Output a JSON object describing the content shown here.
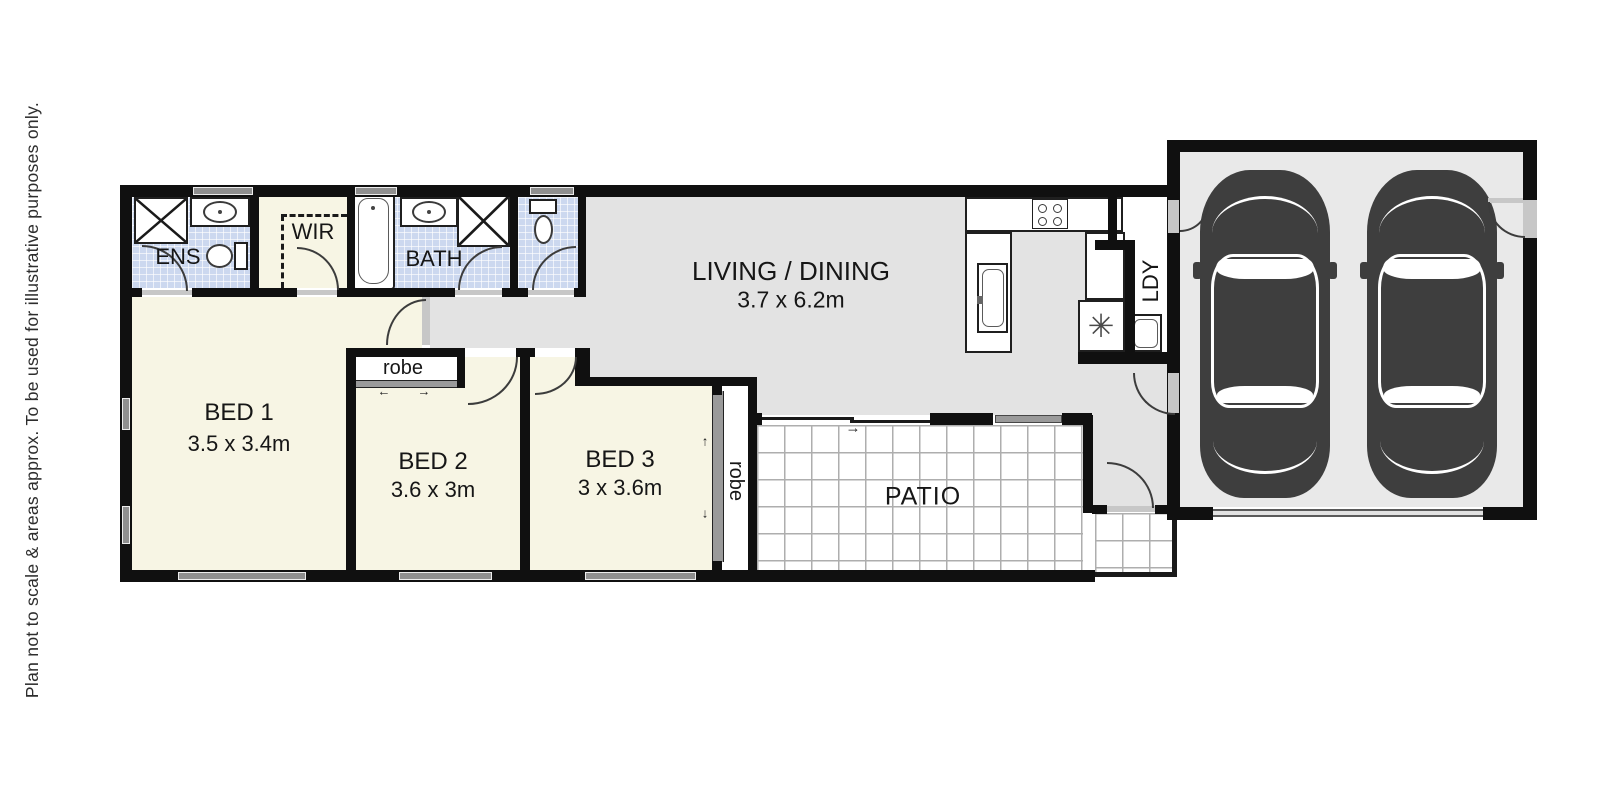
{
  "disclaimer": "Plan not to scale & areas approx. To be used for illustrative purposes only.",
  "rooms": {
    "ens": {
      "label": "ENS"
    },
    "wir": {
      "label": "WIR"
    },
    "bath": {
      "label": "BATH"
    },
    "bed1": {
      "label": "BED 1",
      "dims": "3.5 x 3.4m"
    },
    "bed2": {
      "label": "BED 2",
      "dims": "3.6 x 3m"
    },
    "bed3": {
      "label": "BED 3",
      "dims": "3 x 3.6m"
    },
    "robe_bed2": {
      "label": "robe"
    },
    "robe_bed3": {
      "label": "robe"
    },
    "living": {
      "label": "LIVING / DINING",
      "dims": "3.7 x 6.2m"
    },
    "ldy": {
      "label": "LDY"
    },
    "patio": {
      "label": "PATIO"
    }
  },
  "symbols": {
    "hot_water": "✳",
    "slide_right": "→",
    "slide_left": "←",
    "slide_up": "↑",
    "slide_down": "↓"
  },
  "colors": {
    "wall": "#101010",
    "bedroom_floor": "#f7f5e4",
    "living_floor": "#e3e3e3",
    "garage_floor": "#e9e9e9",
    "wet_area_tile": "#ccd8ef",
    "window": "#8f8f8f",
    "car_body": "#3e3e3e"
  }
}
